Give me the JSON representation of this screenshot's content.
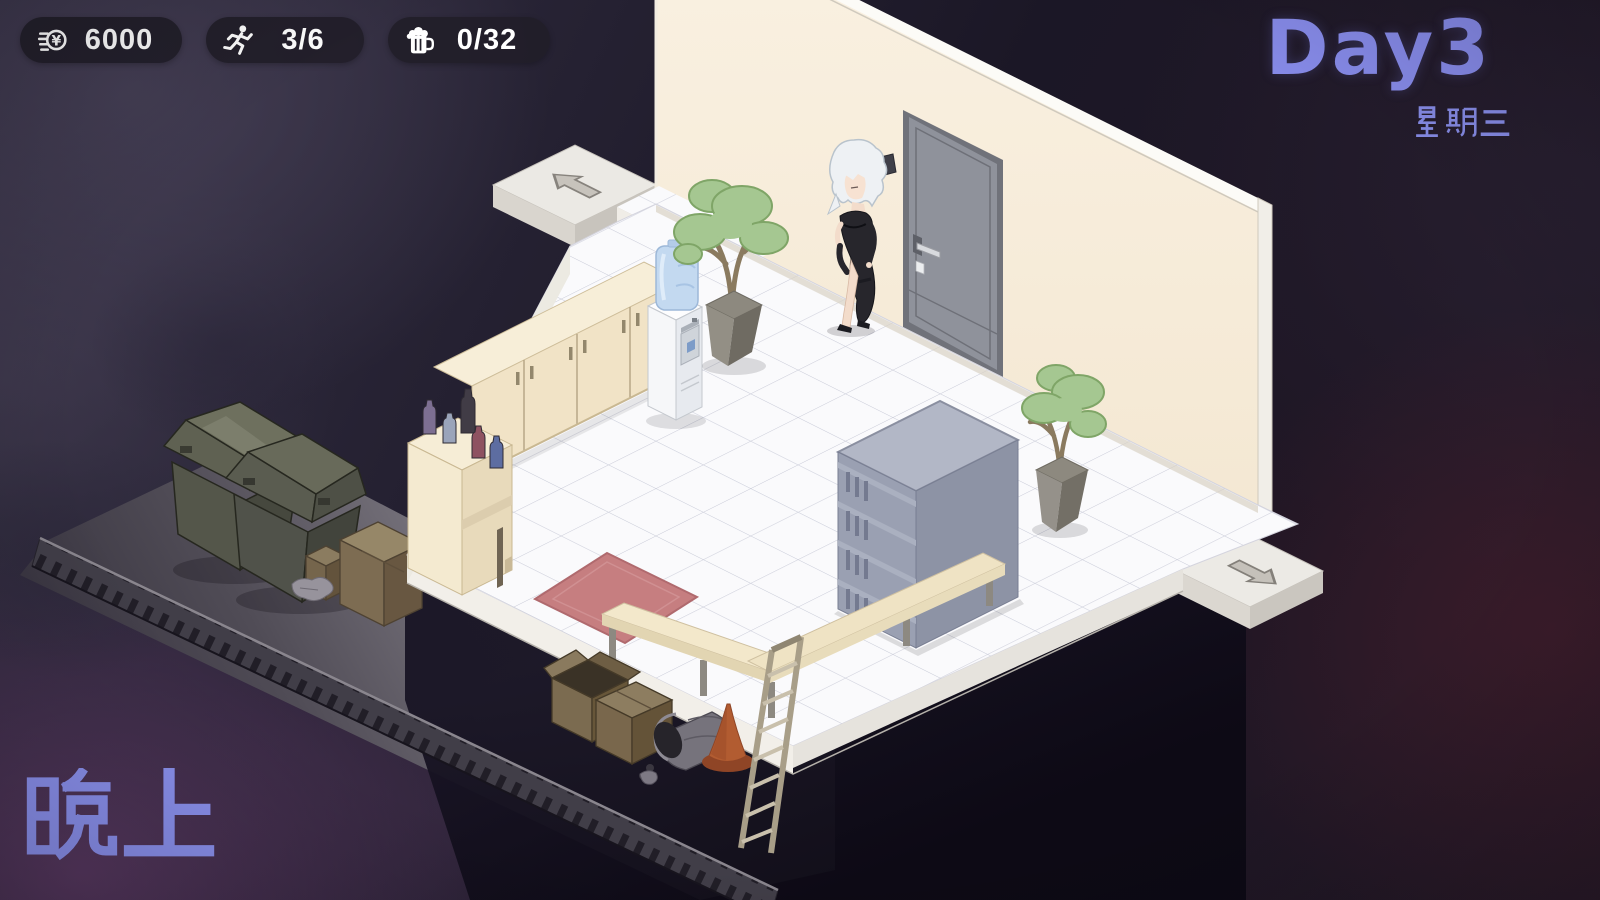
{
  "hud": {
    "money": {
      "icon": "yen-coin-icon",
      "value": "6000"
    },
    "energy": {
      "icon": "runner-icon",
      "value": "3/6"
    },
    "beer": {
      "icon": "beer-mug-icon",
      "value": "0/32"
    },
    "day_label": "Day3",
    "weekday": "星期三",
    "time_of_day": "晚上"
  },
  "colors": {
    "accent_text": "#8589e6",
    "hud_pill_bg": "#211e29",
    "hud_text": "#ffffff",
    "wall": "#f8eedd",
    "floor_tile": "#fafafc",
    "mat": "#c67e80"
  },
  "scene": {
    "objects": [
      "left-exit-arrow",
      "right-exit-arrow",
      "room-door",
      "npc-girl",
      "water-cooler",
      "potted-tree-left",
      "potted-tree-right",
      "sideboard-cabinets",
      "bar-counter",
      "bottles",
      "red-mat",
      "gray-locker",
      "l-bench",
      "ladder",
      "trash-bin-1",
      "trash-bin-2",
      "cardboard-boxes",
      "fallen-can",
      "traffic-cone",
      "drain-grate",
      "alley-ground"
    ]
  }
}
